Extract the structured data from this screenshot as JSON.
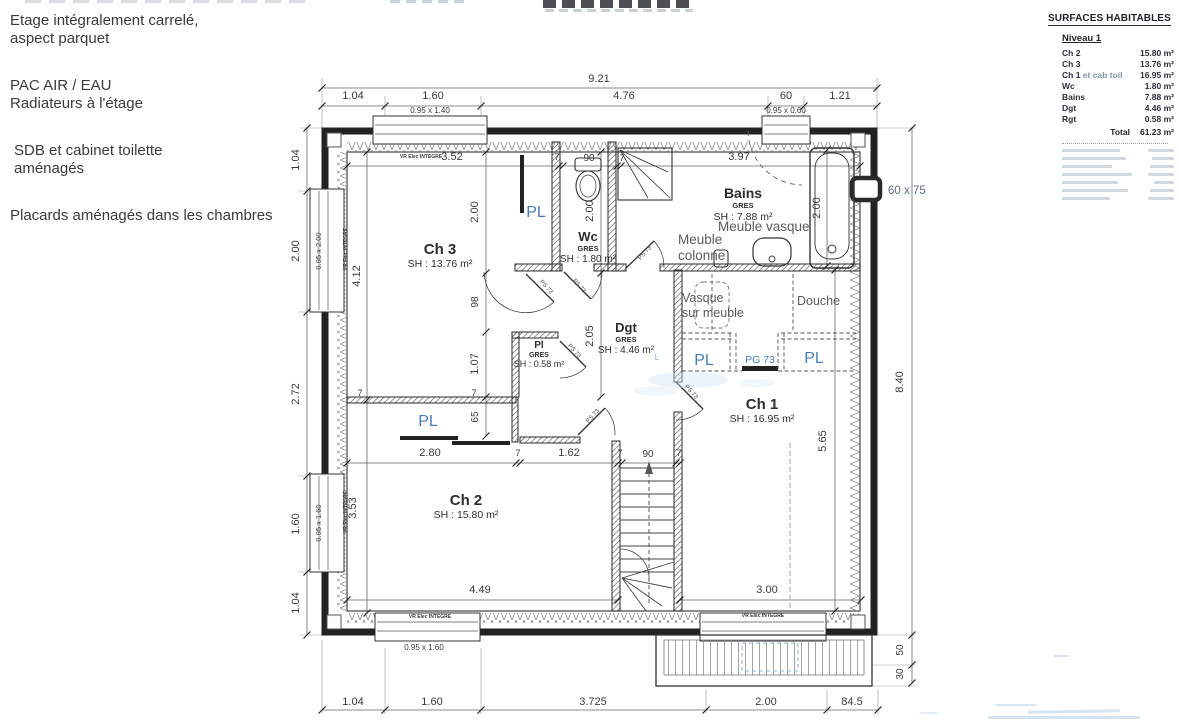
{
  "notes": [
    "Etage intégralement carrelé,\naspect parquet",
    "PAC AIR / EAU\nRadiateurs à l'étage",
    "SDB et cabinet toilette\naménagés",
    "Placards aménagés dans les chambres"
  ],
  "table": {
    "title": "SURFACES HABITABLES",
    "level": "Niveau 1",
    "rows": [
      {
        "label": "Ch 2",
        "value": "15.80 m²"
      },
      {
        "label": "Ch 3",
        "value": "13.76 m²"
      },
      {
        "label": "Ch 1",
        "muted": "et cab toil",
        "value": "16.95 m²"
      },
      {
        "label": "Wc",
        "value": "1.80 m²"
      },
      {
        "label": "Bains",
        "value": "7.88 m²"
      },
      {
        "label": "Dgt",
        "value": "4.46 m²"
      },
      {
        "label": "Rgt",
        "value": "0.58 m²"
      }
    ],
    "total_label": "Total",
    "total_value": "61.23 m²"
  },
  "plan": {
    "colors": {
      "dim": "#3a3a3a",
      "ink": "#2d2d2d",
      "blue": "#4a7db6",
      "lblue": "#7fa8d4",
      "gray": "#5c5c5c",
      "bluegray": "#5d7183",
      "mid": "#4a4a4a"
    },
    "labels": [
      {
        "t": "9.21",
        "x": 599,
        "y": 82
      },
      {
        "t": "1.04",
        "x": 353,
        "y": 99
      },
      {
        "t": "1.60",
        "x": 433,
        "y": 99
      },
      {
        "t": "4.76",
        "x": 624,
        "y": 99
      },
      {
        "t": "60",
        "x": 786,
        "y": 99
      },
      {
        "t": "1.21",
        "x": 840,
        "y": 99
      },
      {
        "t": "1.04",
        "x": 299,
        "y": 160,
        "r": -90
      },
      {
        "t": "2.00",
        "x": 299,
        "y": 251,
        "r": -90
      },
      {
        "t": "2.72",
        "x": 299,
        "y": 394,
        "r": -90
      },
      {
        "t": "1.60",
        "x": 299,
        "y": 524,
        "r": -90
      },
      {
        "t": "1.04",
        "x": 299,
        "y": 603,
        "r": -90
      },
      {
        "t": "8.40",
        "x": 903,
        "y": 382,
        "r": -90
      },
      {
        "t": "50",
        "x": 903,
        "y": 650,
        "r": -90,
        "s": 10
      },
      {
        "t": "30",
        "x": 903,
        "y": 674,
        "r": -90,
        "s": 10
      },
      {
        "t": "1.04",
        "x": 353,
        "y": 705
      },
      {
        "t": "1.60",
        "x": 432,
        "y": 705
      },
      {
        "t": "3.725",
        "x": 593,
        "y": 705
      },
      {
        "t": "2.00",
        "x": 766,
        "y": 705
      },
      {
        "t": "84.5",
        "x": 852,
        "y": 705
      },
      {
        "t": "60 x 75",
        "x": 888,
        "y": 194,
        "a": "s",
        "s": 11.5,
        "c": "bluegray"
      },
      {
        "t": "3.52",
        "x": 452,
        "y": 160
      },
      {
        "t": "7",
        "x": 557,
        "y": 160,
        "s": 9
      },
      {
        "t": "90",
        "x": 589,
        "y": 161,
        "s": 10
      },
      {
        "t": "7",
        "x": 622,
        "y": 161,
        "s": 9
      },
      {
        "t": "3.97",
        "x": 739,
        "y": 160
      },
      {
        "t": "4.12",
        "x": 360,
        "y": 276,
        "r": -90
      },
      {
        "t": "3.53",
        "x": 356,
        "y": 508,
        "r": -90
      },
      {
        "t": "2.00",
        "x": 478,
        "y": 212,
        "r": -90
      },
      {
        "t": "98",
        "x": 478,
        "y": 302,
        "r": -90,
        "s": 10
      },
      {
        "t": "1.07",
        "x": 478,
        "y": 364,
        "r": -90
      },
      {
        "t": "65",
        "x": 478,
        "y": 417,
        "r": -90,
        "s": 10
      },
      {
        "t": "2.00",
        "x": 593,
        "y": 211,
        "r": -90
      },
      {
        "t": "2.05",
        "x": 593,
        "y": 336,
        "r": -90
      },
      {
        "t": "2.00",
        "x": 820,
        "y": 208,
        "r": -90
      },
      {
        "t": "5.65",
        "x": 826,
        "y": 441,
        "r": -90
      },
      {
        "t": "2.80",
        "x": 430,
        "y": 456
      },
      {
        "t": "7",
        "x": 518,
        "y": 456,
        "s": 9
      },
      {
        "t": "1.62",
        "x": 569,
        "y": 456
      },
      {
        "t": "7",
        "x": 620,
        "y": 456,
        "s": 9
      },
      {
        "t": "90",
        "x": 648,
        "y": 457,
        "s": 10
      },
      {
        "t": "7",
        "x": 679,
        "y": 456,
        "s": 9
      },
      {
        "t": "4.49",
        "x": 480,
        "y": 593
      },
      {
        "t": "3.00",
        "x": 767,
        "y": 593
      },
      {
        "t": "7",
        "x": 360,
        "y": 396,
        "s": 9
      },
      {
        "t": "7",
        "x": 474,
        "y": 396,
        "s": 9
      },
      {
        "t": "0.95 x 1.40",
        "x": 430,
        "y": 113,
        "s": 8
      },
      {
        "t": "0.95 x 0.60",
        "x": 786,
        "y": 113,
        "s": 8
      },
      {
        "t": "0.95 x 2.00",
        "x": 321,
        "y": 251,
        "r": -90,
        "s": 7.5
      },
      {
        "t": "0.95 x 1.60",
        "x": 321,
        "y": 523,
        "r": -90,
        "s": 7.5
      },
      {
        "t": "0.95 x 1.60",
        "x": 424,
        "y": 650,
        "s": 8
      },
      {
        "t": "VR Elec INTEGRE",
        "x": 421,
        "y": 158,
        "s": 5,
        "b": 1
      },
      {
        "t": "VR Elec INTEGRE",
        "x": 347,
        "y": 249,
        "r": -90,
        "s": 5,
        "b": 1
      },
      {
        "t": "VR Elec INTEGRE",
        "x": 347,
        "y": 512,
        "r": -90,
        "s": 5,
        "b": 1
      },
      {
        "t": "VR Elec INTEGRE",
        "x": 430,
        "y": 618,
        "s": 5,
        "b": 1
      },
      {
        "t": "VR Elec INTEGRE",
        "x": 763,
        "y": 617,
        "s": 5,
        "b": 1
      },
      {
        "t": "Ch 3",
        "x": 440,
        "y": 254,
        "s": 15,
        "b": 1,
        "c": "ink"
      },
      {
        "t": "SH : 13.76 m²",
        "x": 440,
        "y": 267,
        "s": 10.5,
        "c": "ink"
      },
      {
        "t": "Ch 2",
        "x": 466,
        "y": 505,
        "s": 15,
        "b": 1,
        "c": "ink"
      },
      {
        "t": "SH : 15.80 m²",
        "x": 466,
        "y": 518,
        "s": 10.5,
        "c": "ink"
      },
      {
        "t": "Ch 1",
        "x": 762,
        "y": 409,
        "s": 15,
        "b": 1,
        "c": "ink"
      },
      {
        "t": "SH : 16.95 m²",
        "x": 762,
        "y": 422,
        "s": 10.5,
        "c": "ink"
      },
      {
        "t": "Bains",
        "x": 743,
        "y": 198,
        "s": 14,
        "b": 1,
        "c": "ink"
      },
      {
        "t": "GRES",
        "x": 743,
        "y": 208,
        "s": 7.5,
        "b": 1,
        "c": "ink"
      },
      {
        "t": "SH : 7.88 m²",
        "x": 743,
        "y": 220,
        "s": 10.5,
        "c": "ink"
      },
      {
        "t": "Wc",
        "x": 588,
        "y": 241,
        "s": 13,
        "b": 1,
        "c": "ink"
      },
      {
        "t": "GRES",
        "x": 588,
        "y": 251,
        "s": 7.5,
        "b": 1,
        "c": "ink"
      },
      {
        "t": "SH : 1.80 m²",
        "x": 588,
        "y": 262,
        "s": 10,
        "c": "ink"
      },
      {
        "t": "Dgt",
        "x": 626,
        "y": 332,
        "s": 13,
        "b": 1,
        "c": "ink"
      },
      {
        "t": "GRES",
        "x": 626,
        "y": 342,
        "s": 7.5,
        "b": 1,
        "c": "ink"
      },
      {
        "t": "SH : 4.46 m²",
        "x": 626,
        "y": 353,
        "s": 10,
        "c": "ink"
      },
      {
        "t": "Pl",
        "x": 539,
        "y": 348,
        "s": 10,
        "b": 1,
        "c": "ink"
      },
      {
        "t": "GRES",
        "x": 539,
        "y": 357,
        "s": 7,
        "b": 1,
        "c": "ink"
      },
      {
        "t": "SH : 0.58 m²",
        "x": 539,
        "y": 367,
        "s": 9,
        "c": "ink"
      },
      {
        "t": "PL",
        "x": 536,
        "y": 217,
        "s": 16,
        "c": "blue"
      },
      {
        "t": "PL",
        "x": 428,
        "y": 426,
        "s": 16,
        "c": "blue"
      },
      {
        "t": "PL",
        "x": 704,
        "y": 365,
        "s": 16,
        "c": "blue"
      },
      {
        "t": "PL",
        "x": 814,
        "y": 363,
        "s": 16,
        "c": "blue"
      },
      {
        "t": "PG 73",
        "x": 760,
        "y": 363,
        "s": 10.5,
        "c": "blue"
      },
      {
        "t": "Meuble vasque",
        "x": 718,
        "y": 231,
        "s": 13.5,
        "c": "gray",
        "a": "s"
      },
      {
        "t": "Meuble",
        "x": 678,
        "y": 244,
        "s": 13.5,
        "c": "gray",
        "a": "s"
      },
      {
        "t": "colonne",
        "x": 678,
        "y": 260,
        "s": 13.5,
        "c": "gray",
        "a": "s"
      },
      {
        "t": "Vasque",
        "x": 682,
        "y": 302,
        "s": 12.5,
        "c": "gray",
        "a": "s"
      },
      {
        "t": "sur meuble",
        "x": 682,
        "y": 317,
        "s": 12.5,
        "c": "gray",
        "a": "s"
      },
      {
        "t": "Douche",
        "x": 797,
        "y": 305,
        "s": 12.5,
        "c": "gray",
        "a": "s"
      },
      {
        "t": "L",
        "x": 657,
        "y": 360,
        "s": 8,
        "c": "lblue"
      },
      {
        "t": "PS 73",
        "x": 545,
        "y": 288,
        "s": 6,
        "r": 48,
        "c": "mid"
      },
      {
        "t": "PS 73",
        "x": 578,
        "y": 287,
        "s": 6,
        "r": 48,
        "c": "mid"
      },
      {
        "t": "PS 73",
        "x": 646,
        "y": 254,
        "s": 6,
        "r": -48,
        "c": "mid"
      },
      {
        "t": "PS 73",
        "x": 573,
        "y": 352,
        "s": 6,
        "r": 48,
        "c": "mid"
      },
      {
        "t": "PS 73",
        "x": 594,
        "y": 417,
        "s": 6,
        "r": -48,
        "c": "mid"
      },
      {
        "t": "PS 73",
        "x": 690,
        "y": 393,
        "s": 6,
        "r": 48,
        "c": "mid"
      }
    ]
  }
}
